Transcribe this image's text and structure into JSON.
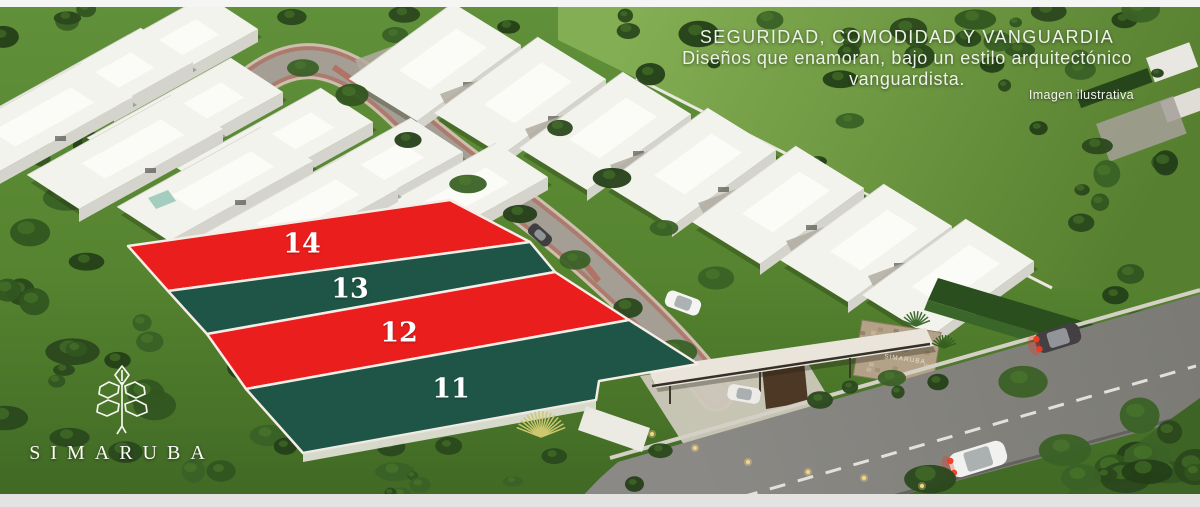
{
  "slogan": {
    "line1": "SEGURIDAD, COMODIDAD Y VANGUARDIA",
    "line2": "Diseños que enamoran, bajo un estilo arquitectónico",
    "line3": "vanguardista."
  },
  "disclaimer": "Imagen ilustrativa",
  "brand": {
    "wordmark": "SIMARUBA"
  },
  "entrance": {
    "sign": "SIMARUBA"
  },
  "lots": [
    {
      "number": "14",
      "color": "#ea1e1d"
    },
    {
      "number": "13",
      "color": "#1e5546"
    },
    {
      "number": "12",
      "color": "#ea1e1d"
    },
    {
      "number": "11",
      "color": "#1e5546"
    }
  ],
  "colors": {
    "lot_red": "#ea1e1d",
    "lot_green": "#1e5546",
    "lot_border": "#f6ede7",
    "label_text": "#ffffff"
  }
}
